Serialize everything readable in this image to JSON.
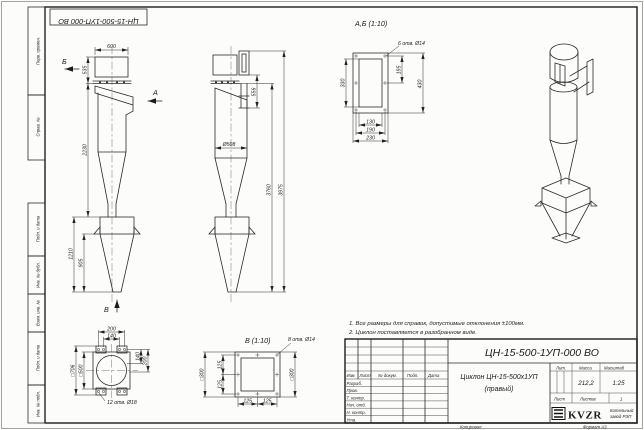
{
  "sheet": {
    "corner_designation": "ЦН-15-500-1УП-000 ВО",
    "copied": "Копировал",
    "format": "Формат А3"
  },
  "frame": {
    "left_top": [
      "Перв. примен.",
      "Справ. №"
    ],
    "left_bottom": [
      "Подп. и дата",
      "Инв. № дубл.",
      "Взам. инв. №",
      "Подп. и дата",
      "Инв. № подл."
    ]
  },
  "notes": [
    "1. Все размеры для справок, допустимые отклонения ±100мм.",
    "2. Циклон поставляется в разобранном виде."
  ],
  "views": {
    "front": {
      "arrow_a": "А",
      "arrow_b": "Б",
      "arrow_v": "В",
      "dim_top_width": "600",
      "dim_cap_height": "535",
      "dim_body_height": "2230",
      "dim_hopper_height": "1210",
      "dim_cone_height": "905"
    },
    "side": {
      "dim_outlet_height": "556",
      "dim_body_dia": "Ø508",
      "dim_height_to_flange": "3760",
      "dim_total_height": "3975"
    },
    "section_ab": {
      "title": "А,Б (1:10)",
      "note_holes": "6 отв. Ø14",
      "dim_inner_height": "330",
      "dim_hole_pitch_v": "195",
      "dim_outer_height": "430",
      "dim_inner_width": "130",
      "dim_hole_pitch_h": "190",
      "dim_outer_width": "230"
    },
    "view_v": {
      "title": "В (1:10)",
      "note_holes": "8 отв. Ø14",
      "dim_square": "□300",
      "dim_pitch": "125"
    },
    "footprint": {
      "note_holes": "12 отв. Ø18",
      "dim_span_top": "200",
      "dim_pitch_top": "140",
      "dim_pitch_right": "140",
      "dim_span_right": "200",
      "dim_outer_square": "□706",
      "dim_inner_square": "□500"
    }
  },
  "title_block": {
    "designation": "ЦН-15-500-1УП-000 ВО",
    "name_line1": "Циклон ЦН-15-500х1УП",
    "name_line2": "(правый)",
    "col_izm": "Изм.",
    "col_list": "Лист",
    "col_doc": "№ докум.",
    "col_sign": "Подп.",
    "col_date": "Дата",
    "rows": [
      "Разраб.",
      "Пров.",
      "Т. контр.",
      "Нач. отд.",
      "Н. контр.",
      "Утв."
    ],
    "lit_label": "Лит.",
    "mass_label": "Масса",
    "scale_label": "Масштаб",
    "mass_value": "212,2",
    "scale_value": "1:25",
    "sheet_label": "Лист",
    "sheets_label": "Листов",
    "sheets_value": "1",
    "logo": "KVZR",
    "company_line1": "Котельный",
    "company_line2": "завод РЭП"
  }
}
